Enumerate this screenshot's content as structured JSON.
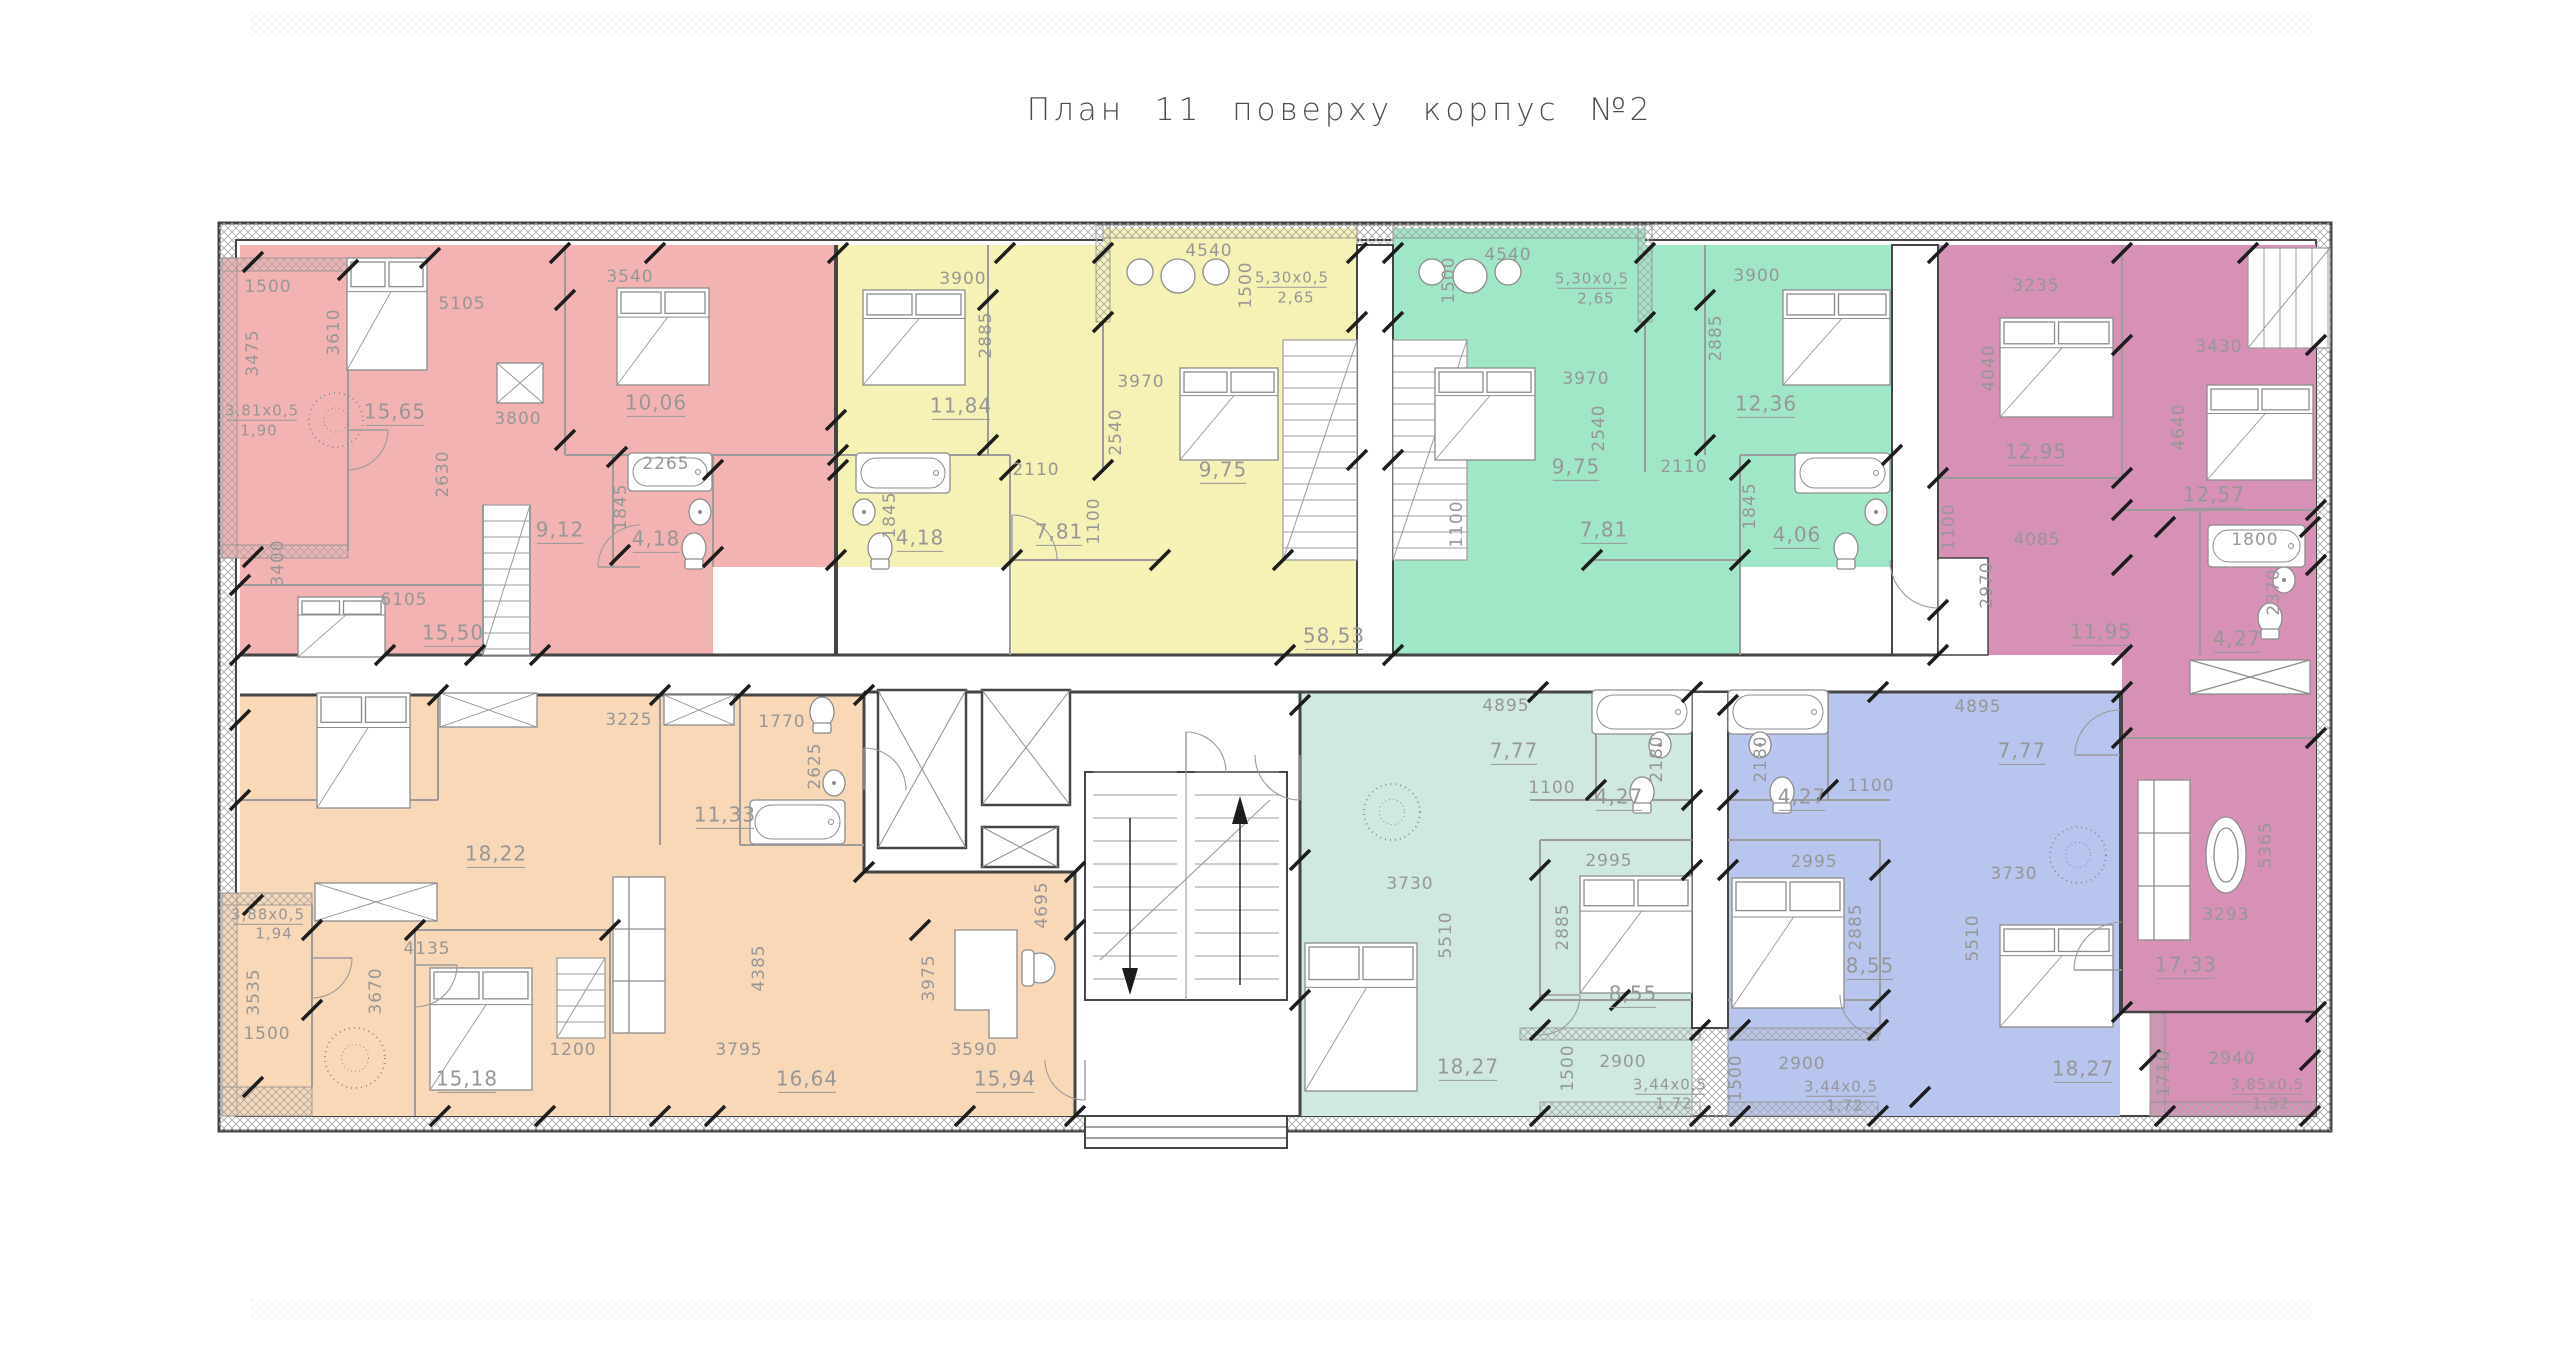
{
  "title": "План 11 поверху корпус №2",
  "corridor": {
    "area_label": "58,53"
  },
  "colors": {
    "red": "#f3b3b3",
    "yellow": "#f6f2b5",
    "green": "#a0e7c7",
    "purple": "#d791b7",
    "orange": "#f9d8b8",
    "teal": "#cfe9e2",
    "blue": "#b8c5ee",
    "wall": "#454545",
    "inner_wall": "#9b9b9b",
    "dim_text": "#969696",
    "tick": "#1c1c1c"
  },
  "apartments": [
    {
      "id": "red",
      "color": "#f3b3b3",
      "labels": [
        {
          "t": "1500",
          "x": 268,
          "y": 287
        },
        {
          "t": "3475",
          "x": 253,
          "y": 353,
          "r": -90
        },
        {
          "t": "3,81x0,5",
          "x": 262,
          "y": 411,
          "s": 15,
          "u": 1
        },
        {
          "t": "1,90",
          "x": 259,
          "y": 431,
          "s": 15
        },
        {
          "t": "3610",
          "x": 334,
          "y": 332,
          "r": -90
        },
        {
          "t": "5105",
          "x": 462,
          "y": 304
        },
        {
          "t": "3540",
          "x": 630,
          "y": 277
        },
        {
          "t": "15,65",
          "x": 395,
          "y": 413,
          "s": 20,
          "u": 1
        },
        {
          "t": "3800",
          "x": 518,
          "y": 419
        },
        {
          "t": "10,06",
          "x": 656,
          "y": 404,
          "s": 20,
          "u": 1
        },
        {
          "t": "2630",
          "x": 443,
          "y": 474,
          "r": -90
        },
        {
          "t": "2265",
          "x": 666,
          "y": 464
        },
        {
          "t": "1845",
          "x": 621,
          "y": 507,
          "r": -90
        },
        {
          "t": "9,12",
          "x": 560,
          "y": 531,
          "s": 20,
          "u": 1
        },
        {
          "t": "4,18",
          "x": 656,
          "y": 540,
          "s": 20,
          "u": 1
        },
        {
          "t": "3400",
          "x": 278,
          "y": 563,
          "r": -90
        },
        {
          "t": "6105",
          "x": 404,
          "y": 600
        },
        {
          "t": "15,50",
          "x": 453,
          "y": 634,
          "s": 20,
          "u": 1
        }
      ]
    },
    {
      "id": "yellow",
      "color": "#f6f2b5",
      "labels": [
        {
          "t": "3900",
          "x": 963,
          "y": 279
        },
        {
          "t": "2885",
          "x": 986,
          "y": 335,
          "r": -90
        },
        {
          "t": "11,84",
          "x": 961,
          "y": 407,
          "s": 20,
          "u": 1
        },
        {
          "t": "4540",
          "x": 1209,
          "y": 251
        },
        {
          "t": "1500",
          "x": 1246,
          "y": 285,
          "r": -90
        },
        {
          "t": "5,30x0,5",
          "x": 1292,
          "y": 278,
          "s": 15,
          "u": 1
        },
        {
          "t": "2,65",
          "x": 1296,
          "y": 298,
          "s": 15
        },
        {
          "t": "3970",
          "x": 1141,
          "y": 382
        },
        {
          "t": "2540",
          "x": 1116,
          "y": 432,
          "r": -90
        },
        {
          "t": "2110",
          "x": 1036,
          "y": 470
        },
        {
          "t": "1100",
          "x": 1094,
          "y": 521,
          "r": -90
        },
        {
          "t": "9,75",
          "x": 1223,
          "y": 471,
          "s": 20,
          "u": 1
        },
        {
          "t": "7,81",
          "x": 1059,
          "y": 533,
          "s": 20,
          "u": 1
        },
        {
          "t": "4,18",
          "x": 920,
          "y": 539,
          "s": 20,
          "u": 1
        },
        {
          "t": "1845",
          "x": 890,
          "y": 515,
          "r": -90
        }
      ]
    },
    {
      "id": "green",
      "color": "#a0e7c7",
      "labels": [
        {
          "t": "4540",
          "x": 1508,
          "y": 255
        },
        {
          "t": "1500",
          "x": 1449,
          "y": 280,
          "r": -90
        },
        {
          "t": "5,30x0,5",
          "x": 1592,
          "y": 279,
          "s": 15,
          "u": 1
        },
        {
          "t": "2,65",
          "x": 1596,
          "y": 299,
          "s": 15
        },
        {
          "t": "3900",
          "x": 1757,
          "y": 276
        },
        {
          "t": "2885",
          "x": 1716,
          "y": 338,
          "r": -90
        },
        {
          "t": "12,36",
          "x": 1766,
          "y": 405,
          "s": 20,
          "u": 1
        },
        {
          "t": "3970",
          "x": 1586,
          "y": 379
        },
        {
          "t": "2540",
          "x": 1599,
          "y": 428,
          "r": -90
        },
        {
          "t": "2110",
          "x": 1684,
          "y": 467
        },
        {
          "t": "9,75",
          "x": 1576,
          "y": 468,
          "s": 20,
          "u": 1
        },
        {
          "t": "7,81",
          "x": 1604,
          "y": 531,
          "s": 20,
          "u": 1
        },
        {
          "t": "1100",
          "x": 1457,
          "y": 524,
          "r": -90
        },
        {
          "t": "1845",
          "x": 1750,
          "y": 506,
          "r": -90
        },
        {
          "t": "4,06",
          "x": 1797,
          "y": 536,
          "s": 20,
          "u": 1
        }
      ]
    },
    {
      "id": "purple",
      "color": "#d791b7",
      "labels": [
        {
          "t": "3235",
          "x": 2036,
          "y": 286
        },
        {
          "t": "4040",
          "x": 1989,
          "y": 368,
          "r": -90
        },
        {
          "t": "12,95",
          "x": 2036,
          "y": 453,
          "s": 20,
          "u": 1
        },
        {
          "t": "3430",
          "x": 2219,
          "y": 347
        },
        {
          "t": "4640",
          "x": 2179,
          "y": 427,
          "r": -90
        },
        {
          "t": "12,57",
          "x": 2214,
          "y": 496,
          "s": 20,
          "u": 1
        },
        {
          "t": "4085",
          "x": 2037,
          "y": 540
        },
        {
          "t": "1100",
          "x": 1949,
          "y": 527,
          "r": -90
        },
        {
          "t": "2970",
          "x": 1987,
          "y": 585,
          "r": -90
        },
        {
          "t": "11,95",
          "x": 2101,
          "y": 633,
          "s": 20,
          "u": 1
        },
        {
          "t": "1800",
          "x": 2255,
          "y": 540
        },
        {
          "t": "2370",
          "x": 2274,
          "y": 592,
          "r": -90
        },
        {
          "t": "4,27",
          "x": 2237,
          "y": 640,
          "s": 20,
          "u": 1
        },
        {
          "t": "5365",
          "x": 2266,
          "y": 845,
          "r": -90
        },
        {
          "t": "3293",
          "x": 2226,
          "y": 915
        },
        {
          "t": "17,33",
          "x": 2186,
          "y": 966,
          "s": 20,
          "u": 1
        },
        {
          "t": "1710",
          "x": 2164,
          "y": 1073,
          "r": -90
        },
        {
          "t": "2940",
          "x": 2232,
          "y": 1059
        },
        {
          "t": "3,85x0,5",
          "x": 2267,
          "y": 1085,
          "s": 15,
          "u": 1
        },
        {
          "t": "1,92",
          "x": 2271,
          "y": 1104,
          "s": 15
        }
      ]
    },
    {
      "id": "orange",
      "color": "#f9d8b8",
      "labels": [
        {
          "t": "3225",
          "x": 629,
          "y": 720
        },
        {
          "t": "1770",
          "x": 782,
          "y": 722
        },
        {
          "t": "18,22",
          "x": 496,
          "y": 855,
          "s": 20,
          "u": 1
        },
        {
          "t": "11,33",
          "x": 725,
          "y": 816,
          "s": 20,
          "u": 1
        },
        {
          "t": "2625",
          "x": 815,
          "y": 766,
          "r": -90
        },
        {
          "t": "3,88x0,5",
          "x": 268,
          "y": 915,
          "s": 15,
          "u": 1
        },
        {
          "t": "1,94",
          "x": 274,
          "y": 934,
          "s": 15
        },
        {
          "t": "3535",
          "x": 254,
          "y": 992,
          "r": -90
        },
        {
          "t": "1500",
          "x": 267,
          "y": 1034
        },
        {
          "t": "4135",
          "x": 427,
          "y": 949
        },
        {
          "t": "3670",
          "x": 376,
          "y": 991,
          "r": -90
        },
        {
          "t": "15,18",
          "x": 467,
          "y": 1080,
          "s": 20,
          "u": 1
        },
        {
          "t": "1200",
          "x": 573,
          "y": 1050
        },
        {
          "t": "4385",
          "x": 759,
          "y": 968,
          "r": -90
        },
        {
          "t": "3795",
          "x": 739,
          "y": 1050
        },
        {
          "t": "16,64",
          "x": 807,
          "y": 1080,
          "s": 20,
          "u": 1
        },
        {
          "t": "3975",
          "x": 929,
          "y": 978,
          "r": -90
        },
        {
          "t": "3590",
          "x": 974,
          "y": 1050
        },
        {
          "t": "15,94",
          "x": 1005,
          "y": 1080,
          "s": 20,
          "u": 1
        },
        {
          "t": "4695",
          "x": 1042,
          "y": 905,
          "r": -90
        }
      ]
    },
    {
      "id": "teal",
      "color": "#cfe9e2",
      "labels": [
        {
          "t": "4895",
          "x": 1506,
          "y": 706
        },
        {
          "t": "7,77",
          "x": 1514,
          "y": 752,
          "s": 20,
          "u": 1
        },
        {
          "t": "2180",
          "x": 1657,
          "y": 759,
          "r": -90
        },
        {
          "t": "1100",
          "x": 1552,
          "y": 788
        },
        {
          "t": "4,27",
          "x": 1619,
          "y": 798,
          "s": 20,
          "u": 1
        },
        {
          "t": "2995",
          "x": 1609,
          "y": 861
        },
        {
          "t": "3730",
          "x": 1410,
          "y": 884
        },
        {
          "t": "5510",
          "x": 1446,
          "y": 935,
          "r": -90
        },
        {
          "t": "2885",
          "x": 1563,
          "y": 927,
          "r": -90
        },
        {
          "t": "8,55",
          "x": 1633,
          "y": 995,
          "s": 20,
          "u": 1
        },
        {
          "t": "18,27",
          "x": 1468,
          "y": 1068,
          "s": 20,
          "u": 1
        },
        {
          "t": "1500",
          "x": 1568,
          "y": 1068,
          "r": -90
        },
        {
          "t": "2900",
          "x": 1623,
          "y": 1062
        },
        {
          "t": "3,44x0,5",
          "x": 1670,
          "y": 1085,
          "s": 15,
          "u": 1
        },
        {
          "t": "1,72",
          "x": 1674,
          "y": 1104,
          "s": 15
        }
      ]
    },
    {
      "id": "blue",
      "color": "#b8c5ee",
      "labels": [
        {
          "t": "4895",
          "x": 1978,
          "y": 707
        },
        {
          "t": "7,77",
          "x": 2022,
          "y": 752,
          "s": 20,
          "u": 1
        },
        {
          "t": "2180",
          "x": 1761,
          "y": 759,
          "r": -90
        },
        {
          "t": "4,27",
          "x": 1802,
          "y": 798,
          "s": 20,
          "u": 1
        },
        {
          "t": "1100",
          "x": 1871,
          "y": 786
        },
        {
          "t": "2995",
          "x": 1814,
          "y": 862
        },
        {
          "t": "2885",
          "x": 1856,
          "y": 927,
          "r": -90
        },
        {
          "t": "8,55",
          "x": 1870,
          "y": 967,
          "s": 20,
          "u": 1
        },
        {
          "t": "3730",
          "x": 2014,
          "y": 874
        },
        {
          "t": "5510",
          "x": 1973,
          "y": 938,
          "r": -90
        },
        {
          "t": "18,27",
          "x": 2083,
          "y": 1070,
          "s": 20,
          "u": 1
        },
        {
          "t": "2900",
          "x": 1802,
          "y": 1064
        },
        {
          "t": "3,44x0,5",
          "x": 1841,
          "y": 1087,
          "s": 15,
          "u": 1
        },
        {
          "t": "1,72",
          "x": 1845,
          "y": 1106,
          "s": 15
        },
        {
          "t": "1500",
          "x": 1736,
          "y": 1078,
          "r": -90
        }
      ]
    },
    {
      "id": "corridor",
      "color": "#ffffff",
      "labels": [
        {
          "t": "58,53",
          "x": 1334,
          "y": 637,
          "s": 20,
          "u": 1
        }
      ]
    }
  ]
}
